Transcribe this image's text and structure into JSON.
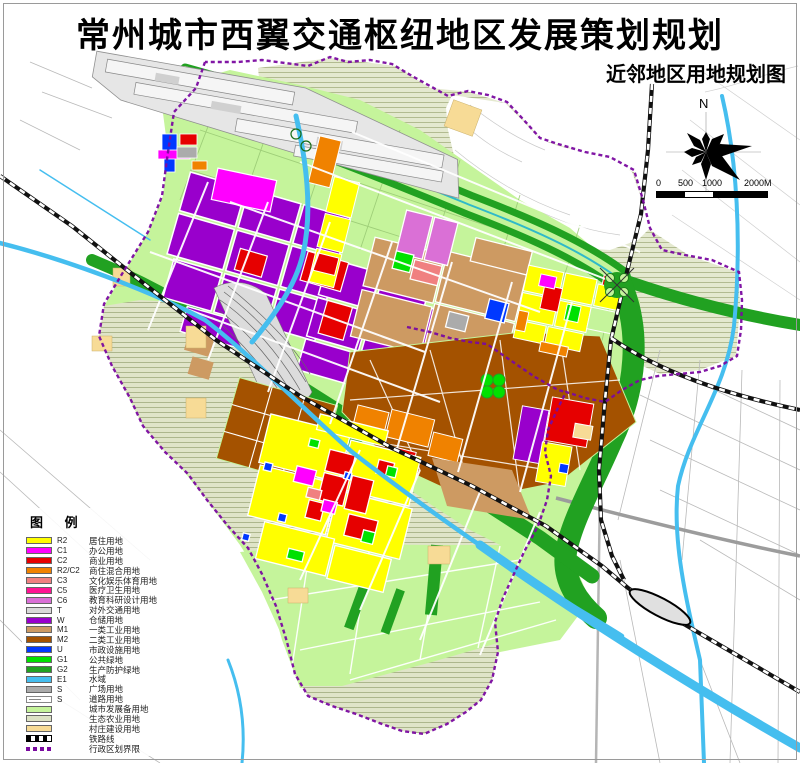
{
  "title": "常州城市西翼交通枢纽地区发展策划规划",
  "subtitle": "近邻地区用地规划图",
  "compass": {
    "north_label": "N"
  },
  "scale_bar": {
    "labels": [
      "0",
      "500",
      "1000",
      "2000M"
    ]
  },
  "legend": {
    "title": "图  例",
    "items": [
      {
        "code": "R2",
        "label": "居住用地",
        "color": "#FFFF00",
        "swatch": "color"
      },
      {
        "code": "C1",
        "label": "办公用地",
        "color": "#FF00FF",
        "swatch": "color"
      },
      {
        "code": "C2",
        "label": "商业用地",
        "color": "#E60000",
        "swatch": "color"
      },
      {
        "code": "R2/C2",
        "label": "商住混合用地",
        "color": "#F08200",
        "swatch": "color"
      },
      {
        "code": "C3",
        "label": "文化娱乐体育用地",
        "color": "#F08080",
        "swatch": "color"
      },
      {
        "code": "C5",
        "label": "医疗卫生用地",
        "color": "#FF1493",
        "swatch": "color"
      },
      {
        "code": "C6",
        "label": "教育科研设计用地",
        "color": "#DA70D6",
        "swatch": "color"
      },
      {
        "code": "T",
        "label": "对外交通用地",
        "color": "#D9D9D9",
        "swatch": "color"
      },
      {
        "code": "W",
        "label": "仓储用地",
        "color": "#9900CC",
        "swatch": "color"
      },
      {
        "code": "M1",
        "label": "一类工业用地",
        "color": "#CD9A62",
        "swatch": "color"
      },
      {
        "code": "M2",
        "label": "二类工业用地",
        "color": "#A45200",
        "swatch": "color"
      },
      {
        "code": "U",
        "label": "市政设施用地",
        "color": "#0038FF",
        "swatch": "color"
      },
      {
        "code": "G1",
        "label": "公共绿地",
        "color": "#00E100",
        "swatch": "color"
      },
      {
        "code": "G2",
        "label": "生产防护绿地",
        "color": "#21A121",
        "swatch": "color"
      },
      {
        "code": "E1",
        "label": "水域",
        "color": "#45BEEF",
        "swatch": "color"
      },
      {
        "code": "S",
        "label": "广场用地",
        "color": "#ABABAB",
        "swatch": "color"
      },
      {
        "code": "S",
        "label": "道路用地",
        "color": "#FFFFFF",
        "swatch": "road"
      },
      {
        "code": "",
        "label": "城市发展备用地",
        "color": "#C5F49B",
        "swatch": "color"
      },
      {
        "code": "",
        "label": "生态农业用地",
        "color": "#DCE2C4",
        "swatch": "color"
      },
      {
        "code": "",
        "label": "村庄建设用地",
        "color": "#F7DB96",
        "swatch": "color"
      },
      {
        "code": "",
        "label": "铁路线",
        "color": "#000000",
        "swatch": "railway"
      },
      {
        "code": "",
        "label": "行政区划界限",
        "color": "#7A0AA0",
        "swatch": "admin"
      }
    ]
  }
}
